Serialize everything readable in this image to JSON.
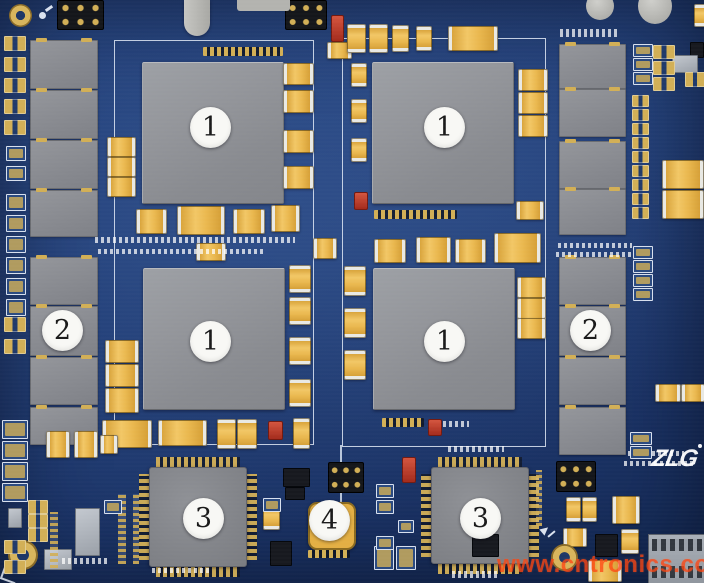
{
  "image": {
    "description": "Photograph of a blue PCB embedded module with numbered component callouts",
    "colors": {
      "board": "#24427c",
      "board_dark": "#142a55",
      "chip": "#94969b",
      "gold": "#d2af56",
      "cap": "#eab84f",
      "silk": "#dfe8f5",
      "callout_bg": "#f8f8f5",
      "callout_text": "#1a1a1a",
      "watermark": "#ff4612",
      "logo": "#ffffff"
    }
  },
  "annotations": {
    "callouts": [
      {
        "label": "1"
      },
      {
        "label": "1"
      },
      {
        "label": "1"
      },
      {
        "label": "1"
      },
      {
        "label": "2"
      },
      {
        "label": "2"
      },
      {
        "label": "3"
      },
      {
        "label": "3"
      },
      {
        "label": "4"
      }
    ]
  },
  "watermark": {
    "text": "www.cntronics.com"
  },
  "logo": {
    "text": "ZLG"
  }
}
